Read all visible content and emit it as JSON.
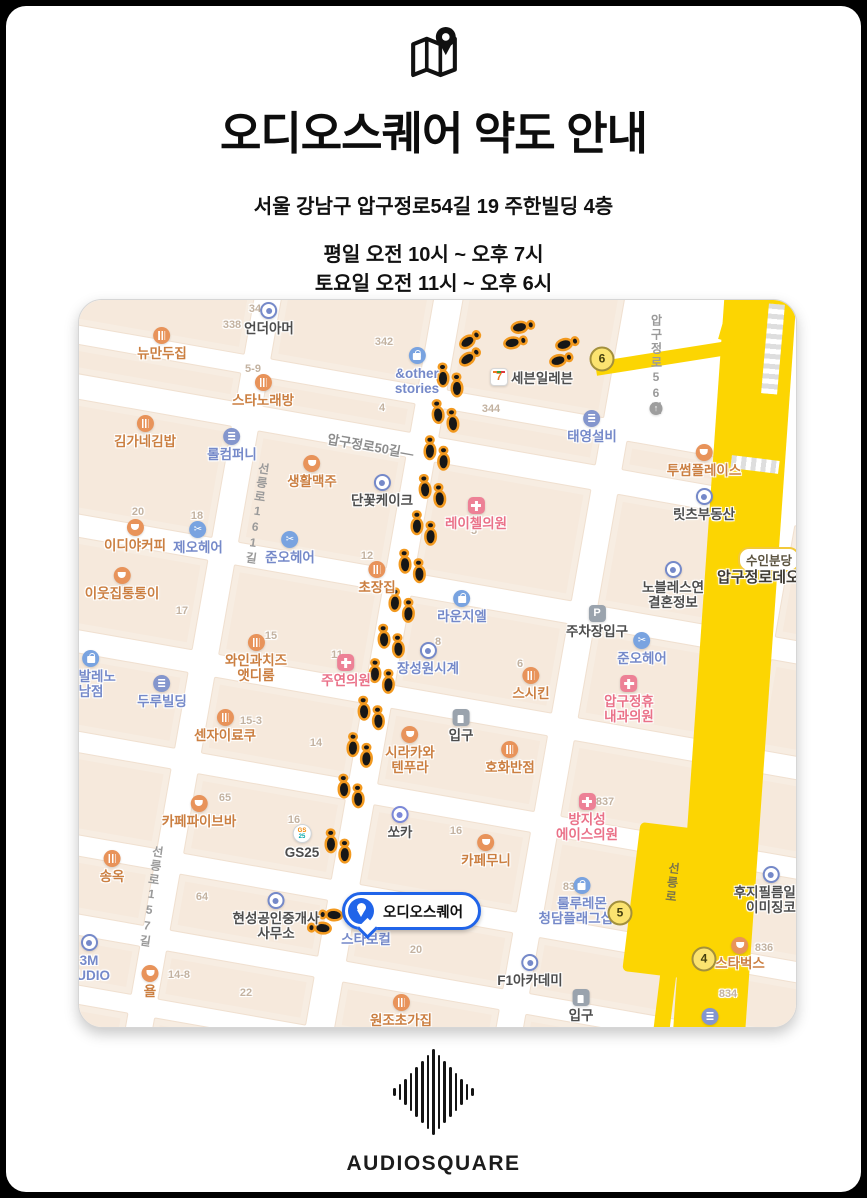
{
  "header": {
    "title": "오디오스퀘어 약도 안내",
    "address": "서울 강남구 압구정로54길 19 주한빌딩 4층",
    "hours_weekday": "평일 오전 10시 ~ 오후 7시",
    "hours_saturday": "토요일 오전 11시 ~ 오후 6시",
    "closed_note": "매주 일요일 정기휴무"
  },
  "footer": {
    "brand_first": "AUDIO",
    "brand_second": "SQUARE"
  },
  "colors": {
    "accent_blue": "#2064e9",
    "line_yellow": "#fcd502",
    "closed_red": "#ed1c24",
    "footprint_orange": "#f2991f"
  },
  "map": {
    "destination": {
      "label": "오디오스퀘어",
      "x": 263,
      "y": 592
    },
    "line_badge": {
      "text": "수인분당",
      "x": 659,
      "y": 247
    },
    "station_name": {
      "text": "압구정로데오",
      "x": 638,
      "y": 266
    },
    "exits": [
      {
        "n": "6",
        "x": 523,
        "y": 59
      },
      {
        "n": "5",
        "x": 541,
        "y": 613
      },
      {
        "n": "4",
        "x": 625,
        "y": 659
      }
    ],
    "roads": [
      {
        "text": "압구정로50길—",
        "x": 248,
        "y": 136,
        "angle": 10
      },
      {
        "text": "선릉로161길",
        "x": 170,
        "y": 162,
        "vertical": true,
        "angle": 8
      },
      {
        "text": "선릉로157길",
        "x": 64,
        "y": 545,
        "vertical": true,
        "angle": 8
      },
      {
        "text": "압구정로56길",
        "x": 569,
        "y": 14,
        "vertical": true,
        "angle": 0
      },
      {
        "text": "선릉로",
        "x": 585,
        "y": 562,
        "vertical": true,
        "angle": 6,
        "on_yellow": true
      }
    ],
    "numbers": [
      {
        "t": "338",
        "x": 153,
        "y": 25
      },
      {
        "t": "34",
        "x": 176,
        "y": 9
      },
      {
        "t": "342",
        "x": 305,
        "y": 42
      },
      {
        "t": "4",
        "x": 303,
        "y": 108
      },
      {
        "t": "5-9",
        "x": 174,
        "y": 69
      },
      {
        "t": "344",
        "x": 412,
        "y": 109
      },
      {
        "t": "20",
        "x": 59,
        "y": 212
      },
      {
        "t": "18",
        "x": 118,
        "y": 216
      },
      {
        "t": "12",
        "x": 288,
        "y": 256
      },
      {
        "t": "17",
        "x": 103,
        "y": 311
      },
      {
        "t": "5",
        "x": 395,
        "y": 231
      },
      {
        "t": "15",
        "x": 192,
        "y": 336
      },
      {
        "t": "11",
        "x": 258,
        "y": 355
      },
      {
        "t": "8",
        "x": 359,
        "y": 342
      },
      {
        "t": "6",
        "x": 441,
        "y": 364
      },
      {
        "t": "15-3",
        "x": 172,
        "y": 421
      },
      {
        "t": "14",
        "x": 237,
        "y": 443
      },
      {
        "t": "837",
        "x": 526,
        "y": 502
      },
      {
        "t": "16",
        "x": 377,
        "y": 531
      },
      {
        "t": "83",
        "x": 490,
        "y": 587
      },
      {
        "t": "65",
        "x": 146,
        "y": 498
      },
      {
        "t": "16",
        "x": 215,
        "y": 520
      },
      {
        "t": "64",
        "x": 123,
        "y": 597
      },
      {
        "t": "14-8",
        "x": 100,
        "y": 675
      },
      {
        "t": "22",
        "x": 167,
        "y": 693
      },
      {
        "t": "20",
        "x": 337,
        "y": 650
      },
      {
        "t": "836",
        "x": 685,
        "y": 648
      },
      {
        "t": "834",
        "x": 649,
        "y": 694
      }
    ],
    "pois": [
      {
        "t": [
          "뉴만두집"
        ],
        "x": 83,
        "y": 27,
        "ic": "food",
        "c": "o"
      },
      {
        "t": [
          "언더아머"
        ],
        "x": 190,
        "y": 2,
        "ic": "dot",
        "c": "d"
      },
      {
        "t": [
          "&other",
          "stories"
        ],
        "x": 338,
        "y": 47,
        "ic": "bag",
        "c": "b"
      },
      {
        "t": [
          "스타노래방"
        ],
        "x": 184,
        "y": 74,
        "ic": "food",
        "c": "o"
      },
      {
        "t": [
          "세븐일레븐"
        ],
        "x": 420,
        "y": 77,
        "ic": "seven",
        "c": "d",
        "side": "right"
      },
      {
        "t": [
          "태영설비"
        ],
        "x": 513,
        "y": 110,
        "ic": "bld",
        "c": "b"
      },
      {
        "t": [
          "투썸플레이스"
        ],
        "x": 625,
        "y": 144,
        "ic": "cup",
        "c": "o"
      },
      {
        "t": [
          "릿츠부동산"
        ],
        "x": 625,
        "y": 188,
        "ic": "dot",
        "c": "d"
      },
      {
        "t": [
          "김가네김밥"
        ],
        "x": 66,
        "y": 115,
        "ic": "food",
        "c": "o"
      },
      {
        "t": [
          "롤컴퍼니"
        ],
        "x": 153,
        "y": 128,
        "ic": "bld",
        "c": "b"
      },
      {
        "t": [
          "생활맥주"
        ],
        "x": 233,
        "y": 155,
        "ic": "cup",
        "c": "o"
      },
      {
        "t": [
          "단꽃케이크"
        ],
        "x": 303,
        "y": 174,
        "ic": "dot",
        "c": "d"
      },
      {
        "t": [
          "이디야커피"
        ],
        "x": 56,
        "y": 219,
        "ic": "cup",
        "c": "o"
      },
      {
        "t": [
          "제오헤어"
        ],
        "x": 119,
        "y": 221,
        "ic": "sci",
        "c": "b"
      },
      {
        "t": [
          "준오헤어"
        ],
        "x": 211,
        "y": 231,
        "ic": "sci",
        "c": "b"
      },
      {
        "t": [
          "초장집"
        ],
        "x": 298,
        "y": 261,
        "ic": "food",
        "c": "o"
      },
      {
        "t": [
          "레이첼의원"
        ],
        "x": 397,
        "y": 197,
        "ic": "clinic",
        "c": "p"
      },
      {
        "t": [
          "이웃집통통이"
        ],
        "x": 43,
        "y": 267,
        "ic": "cup",
        "c": "o"
      },
      {
        "t": [
          "라운지엘"
        ],
        "x": 383,
        "y": 290,
        "ic": "bag",
        "c": "b"
      },
      {
        "t": [
          "노블레스연",
          "결혼정보"
        ],
        "x": 594,
        "y": 261,
        "ic": "dot",
        "c": "d"
      },
      {
        "t": [
          "주차장입구"
        ],
        "x": 518,
        "y": 305,
        "ic": "park",
        "c": "d"
      },
      {
        "t": [
          "준오헤어"
        ],
        "x": 563,
        "y": 332,
        "ic": "sci",
        "c": "b"
      },
      {
        "t": [
          "와인과치즈",
          "앳디룸"
        ],
        "x": 177,
        "y": 334,
        "ic": "food",
        "c": "o"
      },
      {
        "t": [
          "주연의원"
        ],
        "x": 267,
        "y": 354,
        "ic": "clinic",
        "c": "p"
      },
      {
        "t": [
          "장성원시계"
        ],
        "x": 349,
        "y": 342,
        "ic": "dot",
        "c": "b"
      },
      {
        "t": [
          "압구정휴",
          "내과의원"
        ],
        "x": 550,
        "y": 375,
        "ic": "clinic",
        "c": "p"
      },
      {
        "t": [
          "스시킨"
        ],
        "x": 452,
        "y": 367,
        "ic": "food",
        "c": "o"
      },
      {
        "t": [
          "코발레노",
          "남점"
        ],
        "x": 12,
        "y": 350,
        "ic": "bag",
        "c": "b"
      },
      {
        "t": [
          "두루빌딩"
        ],
        "x": 83,
        "y": 375,
        "ic": "bld",
        "c": "b"
      },
      {
        "t": [
          "센자이료쿠"
        ],
        "x": 146,
        "y": 409,
        "ic": "food",
        "c": "o"
      },
      {
        "t": [
          "입구"
        ],
        "x": 382,
        "y": 409,
        "ic": "ent",
        "c": "d"
      },
      {
        "t": [
          "시라카와",
          "텐푸라"
        ],
        "x": 331,
        "y": 426,
        "ic": "cup",
        "c": "o"
      },
      {
        "t": [
          "호화반점"
        ],
        "x": 431,
        "y": 441,
        "ic": "food",
        "c": "o"
      },
      {
        "t": [
          "방지성",
          "에이스의원"
        ],
        "x": 508,
        "y": 493,
        "ic": "clinic",
        "c": "p"
      },
      {
        "t": [
          "쏘카"
        ],
        "x": 321,
        "y": 506,
        "ic": "dotu",
        "c": "d"
      },
      {
        "t": [
          "카페무니"
        ],
        "x": 407,
        "y": 534,
        "ic": "cup",
        "c": "o"
      },
      {
        "t": [
          "룰루레몬",
          "청담플래그십스"
        ],
        "x": 503,
        "y": 577,
        "ic": "bag",
        "c": "b"
      },
      {
        "t": [
          "카페파이브바"
        ],
        "x": 120,
        "y": 495,
        "ic": "cup",
        "c": "o"
      },
      {
        "t": [
          "GS25"
        ],
        "x": 223,
        "y": 524,
        "ic": "gs",
        "c": "d"
      },
      {
        "t": [
          "송옥"
        ],
        "x": 33,
        "y": 550,
        "ic": "food",
        "c": "o"
      },
      {
        "t": [
          "현성공인중개사",
          "사무소"
        ],
        "x": 197,
        "y": 592,
        "ic": "dot",
        "c": "d"
      },
      {
        "t": [
          "3M",
          "TUDIO"
        ],
        "x": 10,
        "y": 634,
        "ic": "dot",
        "c": "b"
      },
      {
        "t": [
          "욜"
        ],
        "x": 71,
        "y": 665,
        "ic": "cup",
        "c": "o"
      },
      {
        "t": [
          "스타보컬"
        ],
        "x": 287,
        "y": 630,
        "ic": null,
        "c": "b"
      },
      {
        "t": [
          "F1아카데미"
        ],
        "x": 451,
        "y": 654,
        "ic": "dot",
        "c": "d"
      },
      {
        "t": [
          "입구"
        ],
        "x": 502,
        "y": 689,
        "ic": "ent",
        "c": "d"
      },
      {
        "t": [
          "원조초가집"
        ],
        "x": 322,
        "y": 694,
        "ic": "food",
        "c": "o"
      },
      {
        "t": [
          "후지필름일레",
          "이미징코"
        ],
        "x": 692,
        "y": 566,
        "ic": "dot",
        "c": "d"
      },
      {
        "t": [
          "스타벅스"
        ],
        "x": 661,
        "y": 637,
        "ic": "cup",
        "c": "o"
      },
      {
        "t": [],
        "x": 631,
        "y": 708,
        "ic": "bld",
        "c": "b"
      },
      {
        "t": [],
        "x": 577,
        "y": 102,
        "ic": "arrow",
        "c": "d"
      }
    ],
    "footprints": [
      {
        "x": 488,
        "y": 50,
        "a": -105
      },
      {
        "x": 443,
        "y": 33,
        "a": -100
      },
      {
        "x": 393,
        "y": 46,
        "a": -125
      },
      {
        "x": 370,
        "y": 77,
        "a": 180
      },
      {
        "x": 365,
        "y": 113,
        "a": 175
      },
      {
        "x": 357,
        "y": 150,
        "a": 182
      },
      {
        "x": 352,
        "y": 188,
        "a": 176
      },
      {
        "x": 344,
        "y": 225,
        "a": 182
      },
      {
        "x": 332,
        "y": 263,
        "a": 178
      },
      {
        "x": 322,
        "y": 302,
        "a": 183
      },
      {
        "x": 311,
        "y": 338,
        "a": 178
      },
      {
        "x": 302,
        "y": 373,
        "a": 183
      },
      {
        "x": 291,
        "y": 410,
        "a": 178
      },
      {
        "x": 280,
        "y": 447,
        "a": 183
      },
      {
        "x": 271,
        "y": 488,
        "a": 179
      },
      {
        "x": 258,
        "y": 543,
        "a": 181
      },
      {
        "x": 243,
        "y": 622,
        "a": 95
      }
    ]
  }
}
